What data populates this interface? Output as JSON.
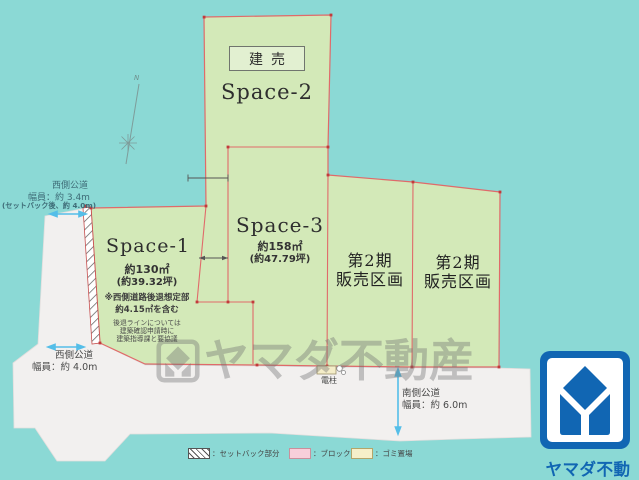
{
  "plots": {
    "space2": {
      "tag": "建売",
      "name": "Space-2"
    },
    "space3": {
      "name": "Space-3",
      "area": "約158㎡",
      "tsubo": "(約47.79坪)"
    },
    "space1": {
      "name": "Space-1",
      "area": "約130㎡",
      "tsubo": "(約39.32坪)",
      "note_line1": "※西側道路後退想定部",
      "note_line2": "約4.15㎡を含む",
      "sub_line1": "後退ラインについては",
      "sub_line2": "建築確認申請時に",
      "sub_line3": "建築指導課と要協議"
    },
    "phase2_left": {
      "line1": "第2期",
      "line2": "販売区画"
    },
    "phase2_right": {
      "line1": "第2期",
      "line2": "販売区画"
    }
  },
  "roads": {
    "west_upper": {
      "name": "西側公道",
      "width": "幅員：約 3.4m",
      "note": "(セットバック後、約 4.0m)"
    },
    "west_lower": {
      "name": "西側公道",
      "width": "幅員：約 4.0m"
    },
    "south": {
      "name": "南側公道",
      "width": "幅員：約 6.0m"
    }
  },
  "annotations": {
    "utility_pole": "電柱",
    "north_label": "N"
  },
  "legend": {
    "setback": "：セットバック部分",
    "block": "：ブロック",
    "garbage": "：ゴミ置場"
  },
  "watermark": "ヤマダ不動産",
  "logo_text": "ヤマダ不動産",
  "colors": {
    "background": "#8BD9D5",
    "plot_green": "#D3E9B8",
    "border_red": "#E06A6A",
    "road_white": "#F2F0EF",
    "logo_blue": "#1166B3",
    "arrow_blue": "#55BEE8"
  }
}
